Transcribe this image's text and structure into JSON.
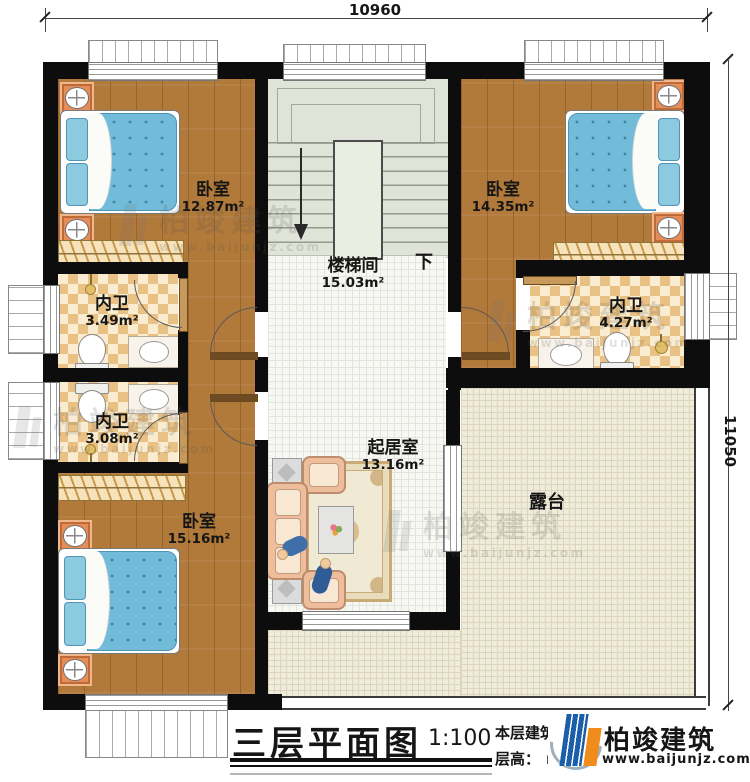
{
  "dimensions": {
    "top": "10960",
    "right": "11050"
  },
  "rooms": {
    "bedroom_tl": {
      "name": "卧室",
      "area": "12.87m²"
    },
    "bedroom_tr": {
      "name": "卧室",
      "area": "14.35m²"
    },
    "bedroom_bl": {
      "name": "卧室",
      "area": "15.16m²"
    },
    "stairwell": {
      "name": "楼梯间",
      "area": "15.03m²",
      "down": "下"
    },
    "bath_left_top": {
      "name": "内卫",
      "area": "3.49m²"
    },
    "bath_left_bottom": {
      "name": "内卫",
      "area": "3.08m²"
    },
    "bath_right": {
      "name": "内卫",
      "area": "4.27m²"
    },
    "living": {
      "name": "起居室",
      "area": "13.16m²"
    },
    "terrace": {
      "name": "露台"
    }
  },
  "titleblock": {
    "title": "三层平面图",
    "scale": "1:100",
    "note_line1": "本层建筑面积：",
    "note_line2": "层高：",
    "note_unit": "m"
  },
  "brand": {
    "name": "柏竣建筑",
    "url": "www.baijunjz.com"
  },
  "colors": {
    "wall": "#0d0d0d",
    "wood": "#b1793a",
    "checker_dark": "#eac184",
    "terrace": "#f0ecdb",
    "brand_blue": "#1b5ea9",
    "brand_orange": "#f08c1c"
  }
}
